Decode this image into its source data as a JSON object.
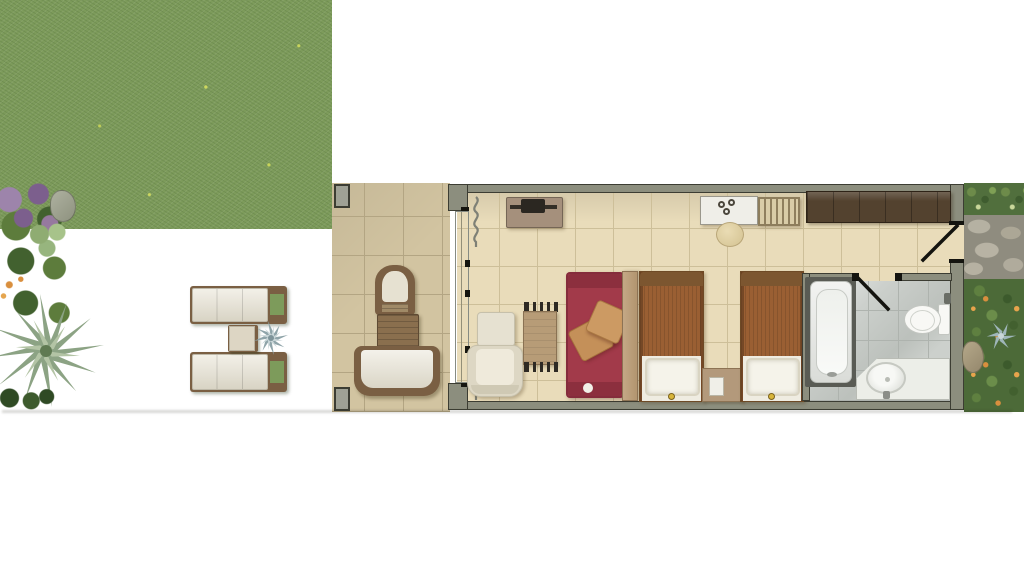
{
  "meta": {
    "kind": "architectural-floor-plan",
    "view": "top-down-render",
    "visible_text": []
  },
  "palette": {
    "page_bg": "#ffffff",
    "grass": "#7d9b5b",
    "foliage_dark": "#42612f",
    "foliage_mid": "#5d7c3c",
    "foliage_light": "#8fac72",
    "flower_purple": "#9d84ab",
    "flower_purple_dark": "#7c5f8d",
    "flower_orange": "#d98f3e",
    "terrace_tile": "#d2c4a1",
    "terrace_grout": "#b3a583",
    "interior_floor": "#e9dcba",
    "interior_grout": "#cdbf99",
    "wall": "#8c8e7e",
    "wall_dark": "#3c3d33",
    "pillar": "#9fa195",
    "glass": "#e7ebe7",
    "curtain": "#7e8076",
    "wood_dark": "#53422f",
    "wood_mid": "#7a5f43",
    "wood_light": "#c4a886",
    "table_wood": "#b79c77",
    "cushion_cream": "#e6e1d1",
    "tv_cabinet": "#a5907c",
    "tv_screen": "#2b2721",
    "sofa_red": "#a23a4a",
    "sofa_red_dark": "#8c2f3e",
    "pillow_tan": "#c49059",
    "bed_cover": "#9a5f33",
    "bed_trim": "#6e4a26",
    "linen_white": "#f5f3ea",
    "nightstand_wood": "#b3997b",
    "bath_floor": "#ccd0cc",
    "bath_grout": "#aeb3ae",
    "porcelain": "#f8f8f5",
    "tub_surround": "#595b54",
    "counter_white": "#eceee8",
    "stone_path": "#8f8c7f",
    "stone_light": "#b5b1a2",
    "hedge_green": "#516f3d",
    "accent_gold": "#d8b53a",
    "door_line": "#14140f"
  },
  "areas": [
    {
      "id": "garden",
      "items": [
        "purple-flower-bed",
        "green-shrubs",
        "light-shrub",
        "rock",
        "palm-plant",
        "dark-shrubs",
        "sun-lounger-1",
        "sun-lounger-2",
        "side-table",
        "agave-plant"
      ]
    },
    {
      "id": "terrace",
      "items": [
        "pillar-top",
        "pillar-bottom",
        "patio-chair",
        "patio-table",
        "patio-sofa"
      ]
    },
    {
      "id": "living-sleeping-room",
      "items": [
        "sliding-glass-wall",
        "curtain-top",
        "curtain-bottom",
        "tv-console",
        "tv",
        "ottoman",
        "armchair",
        "dining-table",
        "dining-chair-top",
        "dining-chair-bottom",
        "red-daybed",
        "throw-pillow-1",
        "throw-pillow-2",
        "wood-divider-panel",
        "twin-bed-1",
        "nightstand",
        "twin-bed-2",
        "desk",
        "stool",
        "luggage-rack",
        "wardrobe"
      ]
    },
    {
      "id": "bathroom",
      "items": [
        "bathtub",
        "toilet",
        "vanity-counter",
        "basin",
        "bathroom-door-swing"
      ]
    },
    {
      "id": "exterior-right",
      "items": [
        "hedge",
        "stone-entry-path",
        "entry-door-swing",
        "flowering-bushes",
        "agave-plant",
        "rock"
      ]
    }
  ]
}
